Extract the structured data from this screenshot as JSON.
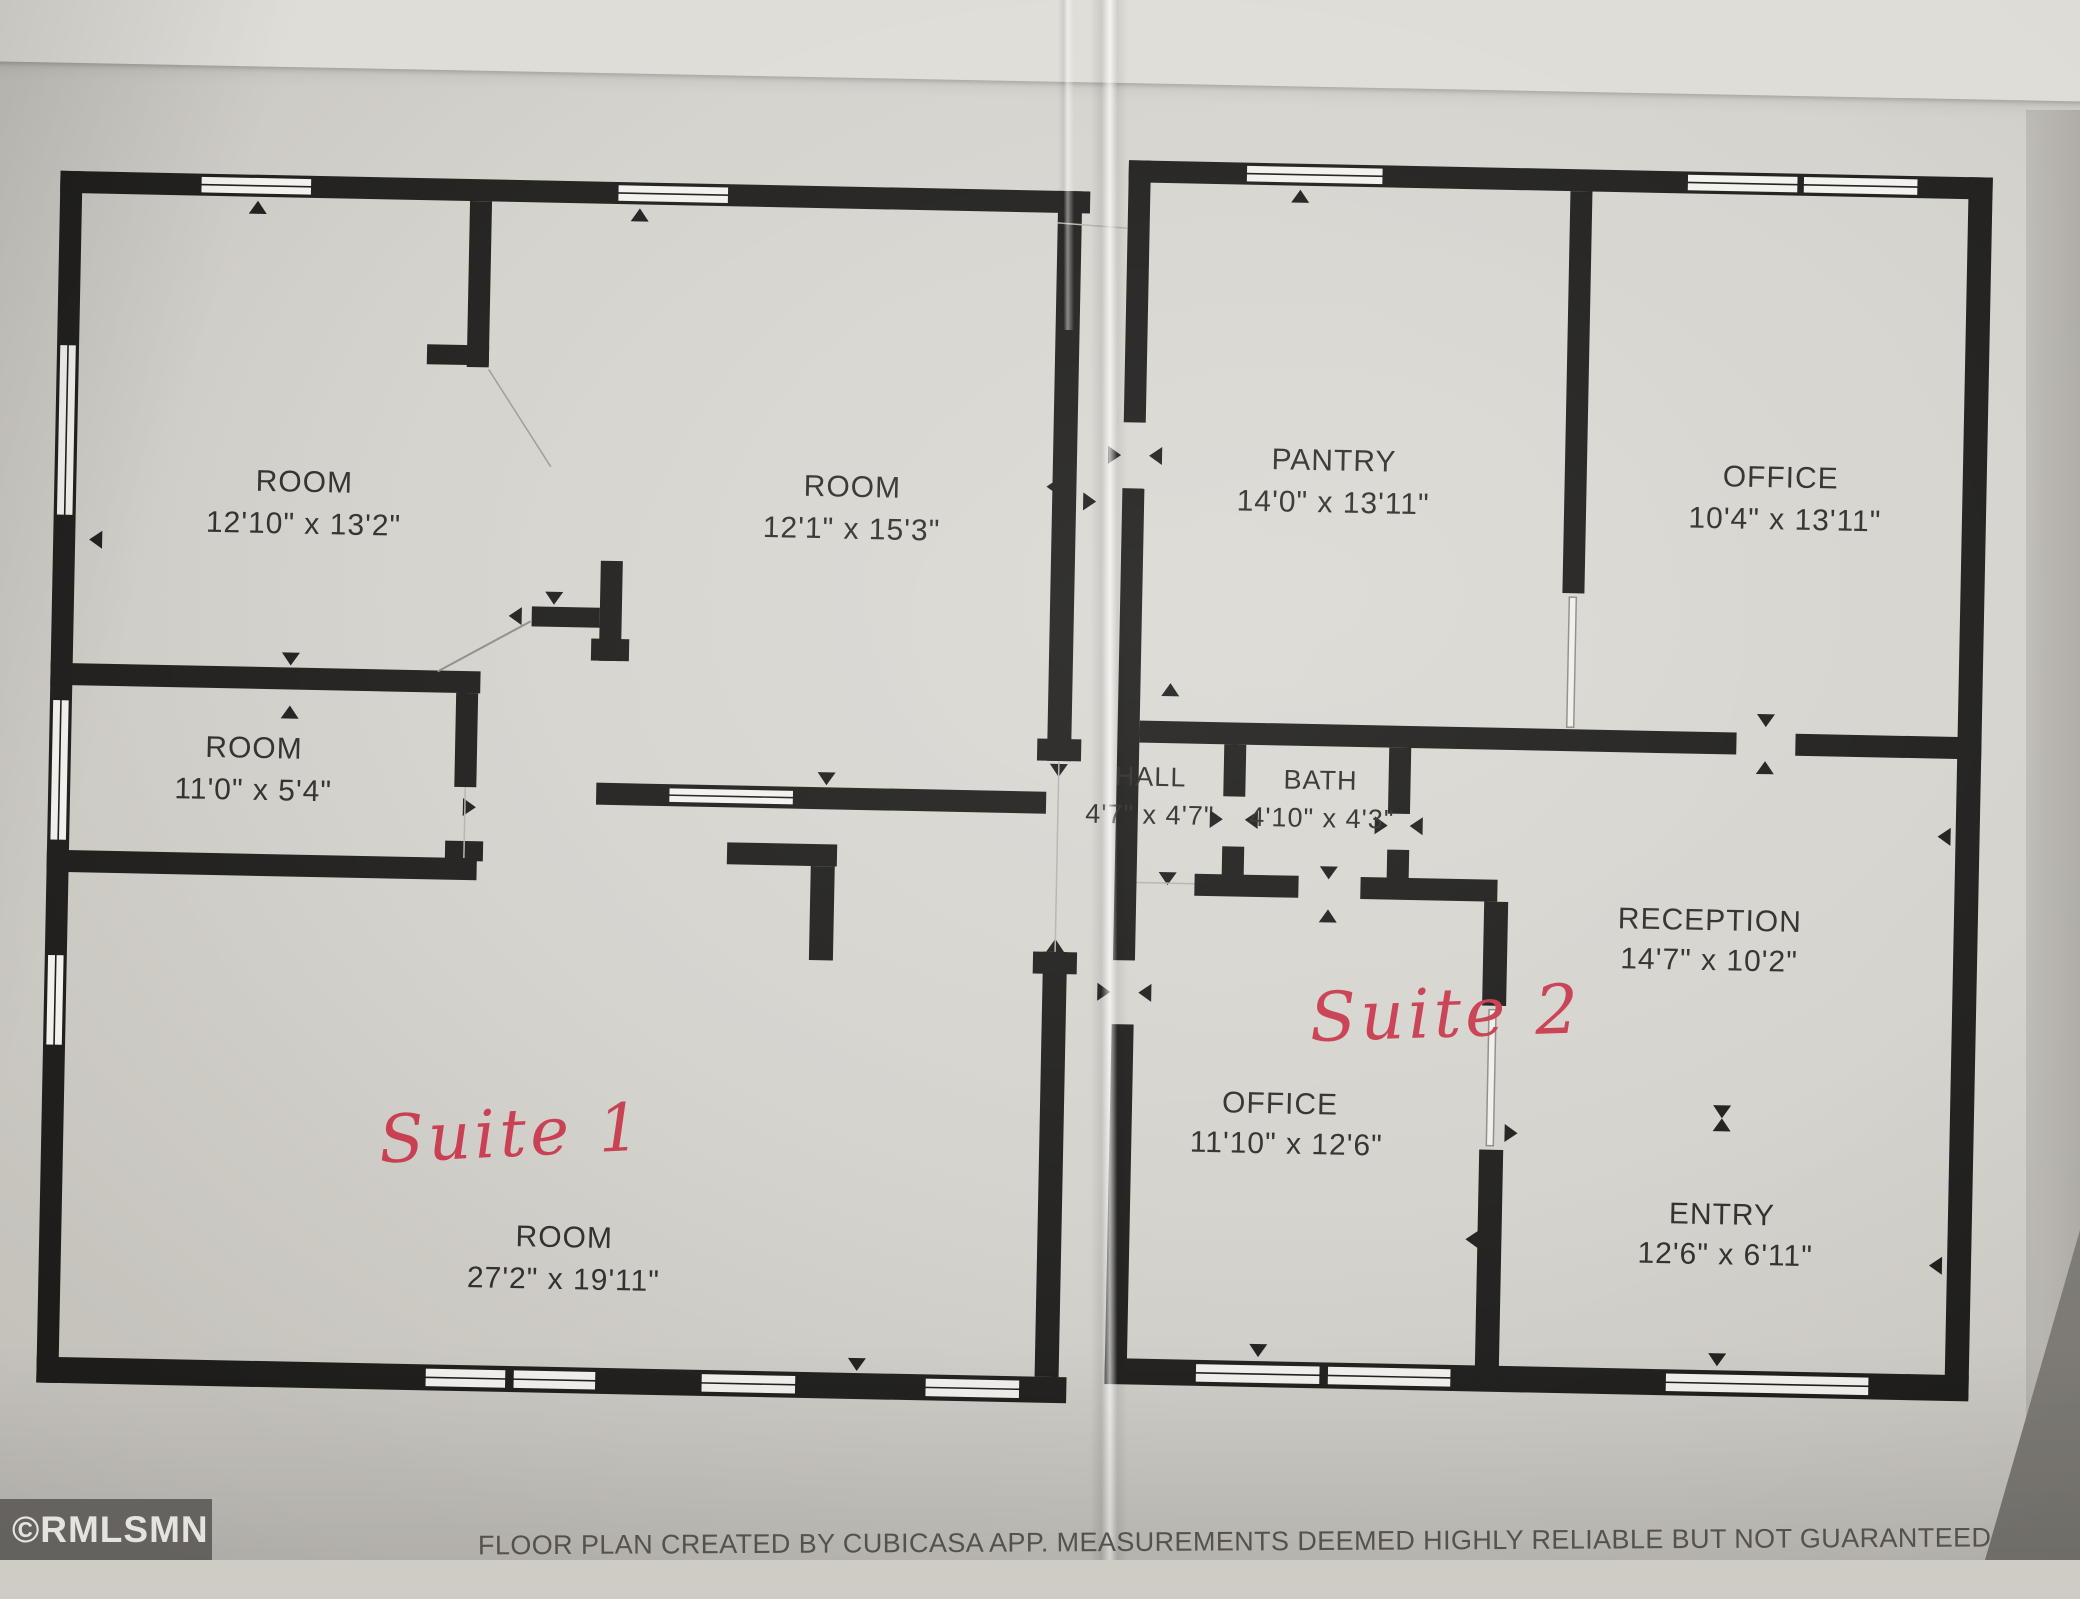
{
  "page": {
    "watermark": "©RMLSMN",
    "disclaimer": "FLOOR PLAN CREATED BY CUBICASA APP. MEASUREMENTS DEEMED HIGHLY RELIABLE BUT NOT GUARANTEED"
  },
  "suite1": {
    "label": "Suite 1",
    "rooms": {
      "room_a": {
        "name": "ROOM",
        "dims": "12'10\" x 13'2\""
      },
      "room_b": {
        "name": "ROOM",
        "dims": "12'1\" x 15'3\""
      },
      "room_c": {
        "name": "ROOM",
        "dims": "11'0\" x 5'4\""
      },
      "room_d": {
        "name": "ROOM",
        "dims": "27'2\" x 19'11\""
      }
    }
  },
  "suite2": {
    "label": "Suite 2",
    "rooms": {
      "pantry": {
        "name": "PANTRY",
        "dims": "14'0\" x 13'11\""
      },
      "office_top": {
        "name": "OFFICE",
        "dims": "10'4\" x 13'11\""
      },
      "hall": {
        "name": "HALL",
        "dims": "4'7\" x 4'7\""
      },
      "bath": {
        "name": "BATH",
        "dims": "4'10\" x 4'3\""
      },
      "reception": {
        "name": "RECEPTION",
        "dims": "14'7\" x 10'2\""
      },
      "office_bottom": {
        "name": "OFFICE",
        "dims": "11'10\" x 12'6\""
      },
      "entry": {
        "name": "ENTRY",
        "dims": "12'6\" x 6'11\""
      }
    }
  },
  "colors": {
    "wall": "#1d1c1a",
    "paper": "#d4d2cc",
    "ink_red": "#c73a4c",
    "label_ink": "#2e2c29"
  }
}
